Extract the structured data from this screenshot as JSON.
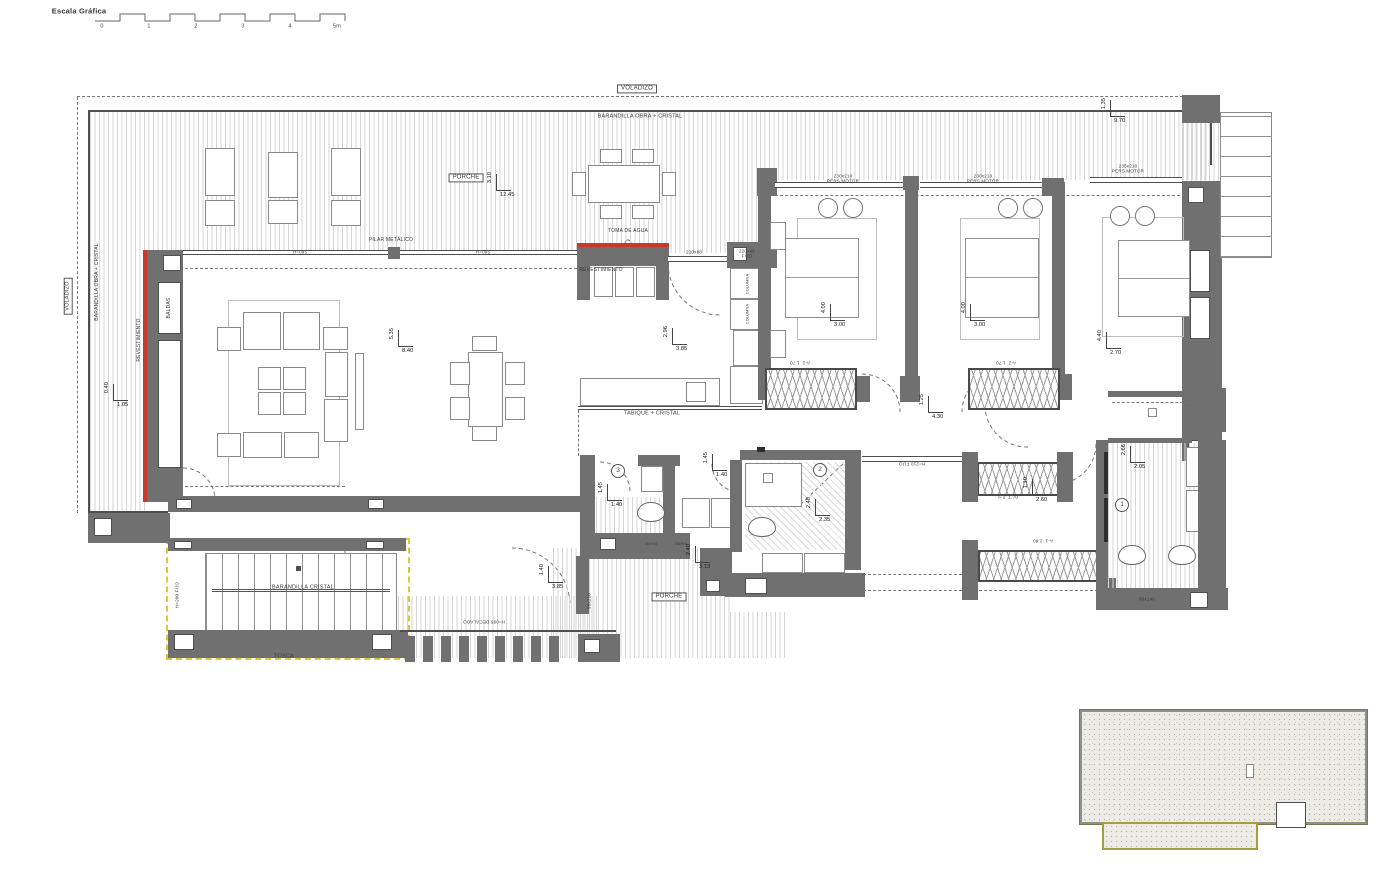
{
  "meta": {
    "scale_label": "Escala Gráfica",
    "scale_ticks": [
      "0",
      "1",
      "2",
      "3",
      "4",
      "5m"
    ],
    "accent_red": "#c63a27",
    "accent_yellow": "#d9ca3b",
    "accent_olive": "#a0a040"
  },
  "labels": [
    {
      "text": "Escala Gráfica",
      "x": 79,
      "y": 11,
      "rot": 0,
      "fs": 7.5,
      "b": 0,
      "bold": 1
    },
    {
      "text": "VOLADIZO",
      "x": 637,
      "y": 89,
      "rot": 0,
      "fs": 6,
      "b": 1
    },
    {
      "text": "BARANDILLA OBRA + CRISTAL",
      "x": 640,
      "y": 117,
      "rot": 0,
      "fs": 5.5
    },
    {
      "text": "VOLADIZO",
      "x": 68,
      "y": 296,
      "rot": -90,
      "fs": 5.5,
      "b": 1
    },
    {
      "text": "BARANDILLA OBRA + CRISTAL",
      "x": 97,
      "y": 282,
      "rot": -90,
      "fs": 5
    },
    {
      "text": "REVESTIMIENTO",
      "x": 139,
      "y": 340,
      "rot": -90,
      "fs": 5
    },
    {
      "text": "BALDAS",
      "x": 169,
      "y": 308,
      "rot": -90,
      "fs": 5
    },
    {
      "text": "PORCHE",
      "x": 466,
      "y": 178,
      "rot": 0,
      "fs": 6,
      "b": 1
    },
    {
      "text": "TOMA DE AGUA",
      "x": 628,
      "y": 231,
      "rot": 0,
      "fs": 5
    },
    {
      "text": "REVESTIMIENTO",
      "x": 601,
      "y": 270,
      "rot": 0,
      "fs": 5
    },
    {
      "text": "PILAR METÁLICO",
      "x": 391,
      "y": 240,
      "rot": 0,
      "fs": 5
    },
    {
      "text": "H=095",
      "x": 300,
      "y": 252,
      "rot": 0,
      "fs": 4.5
    },
    {
      "text": "H=095",
      "x": 483,
      "y": 252,
      "rot": 0,
      "fs": 4.5
    },
    {
      "text": "220x88",
      "x": 694,
      "y": 252,
      "rot": 0,
      "fs": 4.5
    },
    {
      "text": "220x45\nFIJO",
      "x": 747,
      "y": 254,
      "rot": 0,
      "fs": 4.5
    },
    {
      "text": "230x210\nPERS MOTOR",
      "x": 843,
      "y": 179,
      "rot": 0,
      "fs": 4.5
    },
    {
      "text": "230x210\nPERS MOTOR",
      "x": 983,
      "y": 179,
      "rot": 0,
      "fs": 4.5
    },
    {
      "text": "235x210\nPERS MOTOR",
      "x": 1128,
      "y": 169,
      "rot": 0,
      "fs": 4.5
    },
    {
      "text": "TABIQUE + CRISTAL",
      "x": 652,
      "y": 414,
      "rot": 0,
      "fs": 5.5
    },
    {
      "text": "BARANDILLA CRISTAL",
      "x": 303,
      "y": 588,
      "rot": 0,
      "fs": 5.5
    },
    {
      "text": "TOSCA",
      "x": 284,
      "y": 657,
      "rot": 0,
      "fs": 5.5
    },
    {
      "text": "H=200 FIJO",
      "x": 177,
      "y": 595,
      "rot": -90,
      "fs": 4.5
    },
    {
      "text": "H=210 FIJO",
      "x": 912,
      "y": 464,
      "rot": 180,
      "fs": 4.5
    },
    {
      "text": "H=095 DECALADO",
      "x": 484,
      "y": 622,
      "rot": 180,
      "fs": 4.5
    },
    {
      "text": "PORCHE",
      "x": 669,
      "y": 597,
      "rot": 0,
      "fs": 6,
      "b": 1
    },
    {
      "text": "90x210",
      "x": 589,
      "y": 601,
      "rot": -90,
      "fs": 4.5
    },
    {
      "text": "90x140",
      "x": 1147,
      "y": 599,
      "rot": 0,
      "fs": 4.5
    },
    {
      "text": "A-2  1.70",
      "x": 800,
      "y": 363,
      "rot": 180,
      "fs": 4.5
    },
    {
      "text": "A-2  1.70",
      "x": 1006,
      "y": 363,
      "rot": 180,
      "fs": 4.5
    },
    {
      "text": "A-2  1.70",
      "x": 1008,
      "y": 497,
      "rot": 0,
      "fs": 4.5
    },
    {
      "text": "A-1  2.80",
      "x": 1043,
      "y": 541,
      "rot": 180,
      "fs": 4.5
    },
    {
      "text": "04x06",
      "x": 651,
      "y": 543,
      "rot": 180,
      "fs": 4
    },
    {
      "text": "04x06",
      "x": 681,
      "y": 543,
      "rot": 180,
      "fs": 4
    },
    {
      "text": "COLUMNA",
      "x": 748,
      "y": 284,
      "rot": -90,
      "fs": 3.8
    },
    {
      "text": "COLUMNA",
      "x": 748,
      "y": 314,
      "rot": -90,
      "fs": 3.8
    }
  ],
  "dims": [
    {
      "v": "3.10",
      "h": "12.45",
      "x": 496,
      "y": 190
    },
    {
      "v": "5.35",
      "h": "8.40",
      "x": 398,
      "y": 346
    },
    {
      "v": "2.96",
      "h": "3.85",
      "x": 672,
      "y": 344
    },
    {
      "v": "4.00",
      "h": "3.00",
      "x": 830,
      "y": 320
    },
    {
      "v": "4.00",
      "h": "3.00",
      "x": 970,
      "y": 320
    },
    {
      "v": "4.40",
      "h": "2.70",
      "x": 1106,
      "y": 348
    },
    {
      "v": "1.25",
      "h": "4.30",
      "x": 928,
      "y": 412
    },
    {
      "v": "1.45",
      "h": "1.40",
      "x": 607,
      "y": 500
    },
    {
      "v": "1.45",
      "h": "1.40",
      "x": 712,
      "y": 470
    },
    {
      "v": "2.48",
      "h": "2.35",
      "x": 815,
      "y": 515
    },
    {
      "v": "2.66",
      "h": "2.05",
      "x": 1130,
      "y": 462
    },
    {
      "v": "1.10",
      "h": "2.60",
      "x": 1032,
      "y": 495
    },
    {
      "v": "2.40",
      "h": "3.13",
      "x": 695,
      "y": 562
    },
    {
      "v": "1.40",
      "h": "3.85",
      "x": 548,
      "y": 582
    },
    {
      "v": "0.40",
      "h": "1.05",
      "x": 113,
      "y": 400
    },
    {
      "v": "1.35",
      "h": "9.70",
      "x": 1110,
      "y": 116
    }
  ],
  "circles": [
    {
      "n": "3",
      "x": 618,
      "y": 471
    },
    {
      "n": "2",
      "x": 820,
      "y": 470
    },
    {
      "n": "1",
      "x": 1122,
      "y": 505
    }
  ]
}
